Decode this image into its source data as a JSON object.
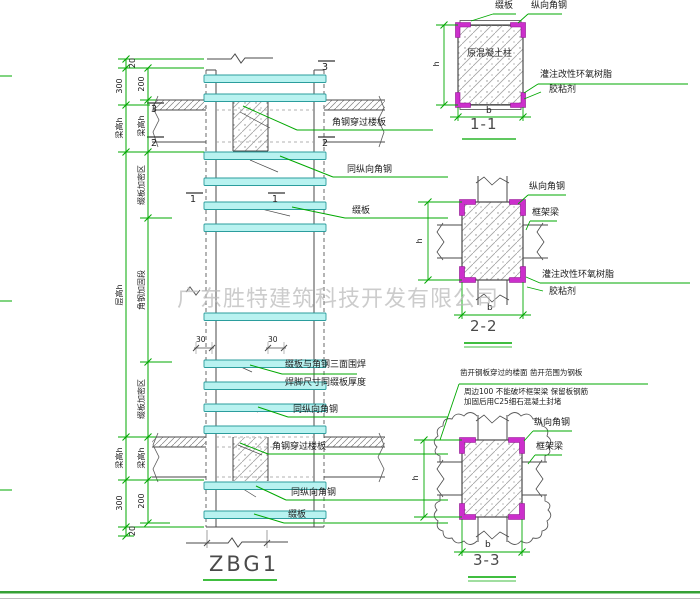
{
  "watermark": "广东胜特建筑科技开发有限公司",
  "drawing_title": "ZBG1",
  "colors": {
    "dim_green": "#00a800",
    "batten_cyan": "#b8f2f0",
    "angle_magenta": "#cc2fcc",
    "border_green": "#35a035"
  },
  "shared": {
    "batten": "缀板",
    "longitudinal_angle": "纵向角钢",
    "same_longitudinal_angle": "同纵向角钢",
    "angle_through_slab": "角钢穿过楼板",
    "frame_beam": "框架梁",
    "epoxy_line1": "灌注改性环氧树脂",
    "epoxy_line2": "胶粘剂",
    "original_column": "原混凝土柱",
    "h": "h",
    "b": "b"
  },
  "elevation": {
    "weld_note_line1": "缀板与角钢三面围焊",
    "weld_note_line2": "焊脚尺寸同缀板厚度",
    "dims": {
      "d20": "20",
      "d300": "300",
      "d200": "200",
      "beam_height": "梁高h",
      "storey_height": "层高h",
      "dense_zone": "缀板加密区",
      "strengthen_zone": "角钢加固段",
      "d30": "30"
    },
    "cuts": {
      "c1": "1",
      "c2": "2",
      "c3": "3"
    }
  },
  "sections": {
    "s11": {
      "title": "1-1"
    },
    "s22": {
      "title": "2-2"
    },
    "s33": {
      "title": "3-3",
      "note_line1": "凿开钢板穿过的楼面 凿开范围为钢板",
      "note_line2": "周边100 不能破坏框架梁 保留板钢筋",
      "note_line3": "加固后用C25细石混凝土封堵"
    }
  }
}
